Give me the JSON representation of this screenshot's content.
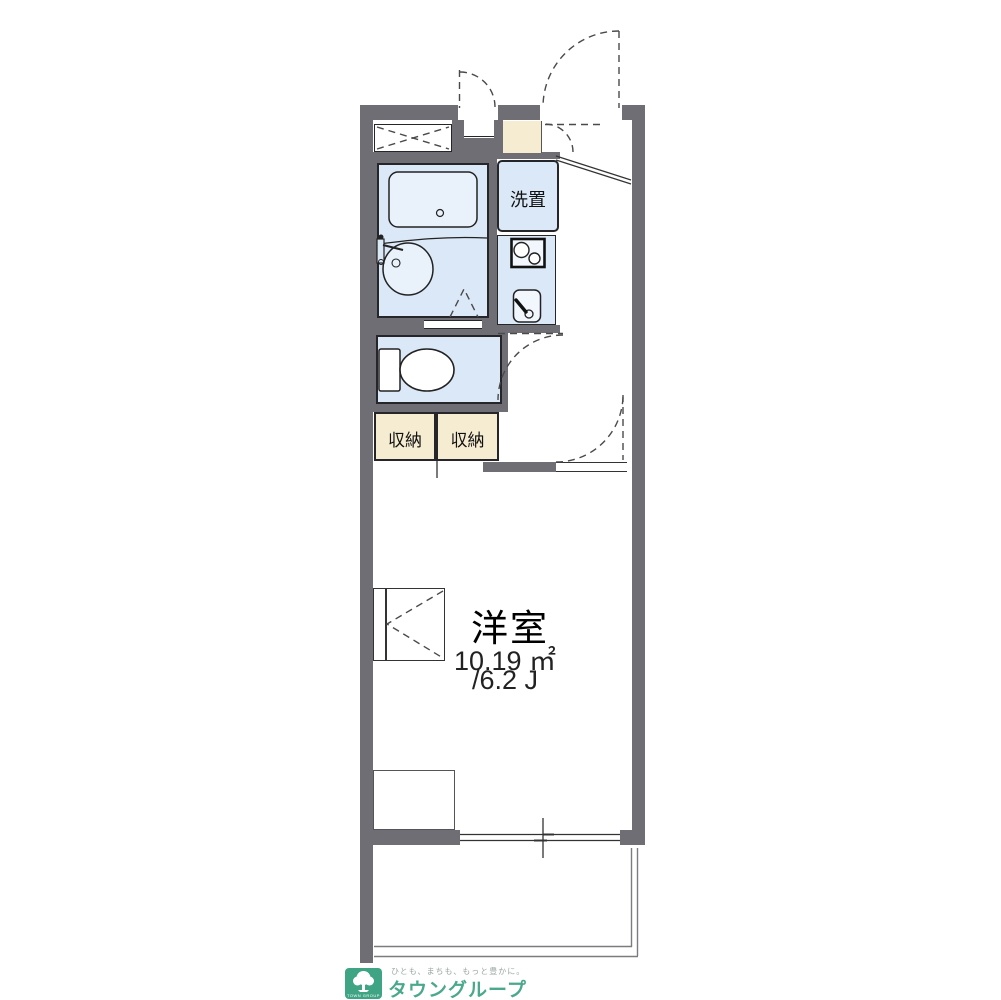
{
  "floorplan": {
    "rooms": {
      "laundry_label": "洗置",
      "storage_left_label": "収納",
      "storage_right_label": "収納",
      "main_room_label": "洋室",
      "main_room_area": "10.19 ㎡",
      "main_room_tatami": "/6.2 J"
    },
    "colors": {
      "wall_gray": "#6e6e74",
      "room_blue": "#dbe8f7",
      "fixture_blue": "#e9f1fb",
      "storage_cream": "#f6ecd2",
      "brand_green": "#3fa483"
    },
    "footer": {
      "tagline": "ひとも、まちも、もっと豊かに。",
      "brand_name": "タウングループ",
      "logo_caption": "TOWN GROUP"
    }
  }
}
